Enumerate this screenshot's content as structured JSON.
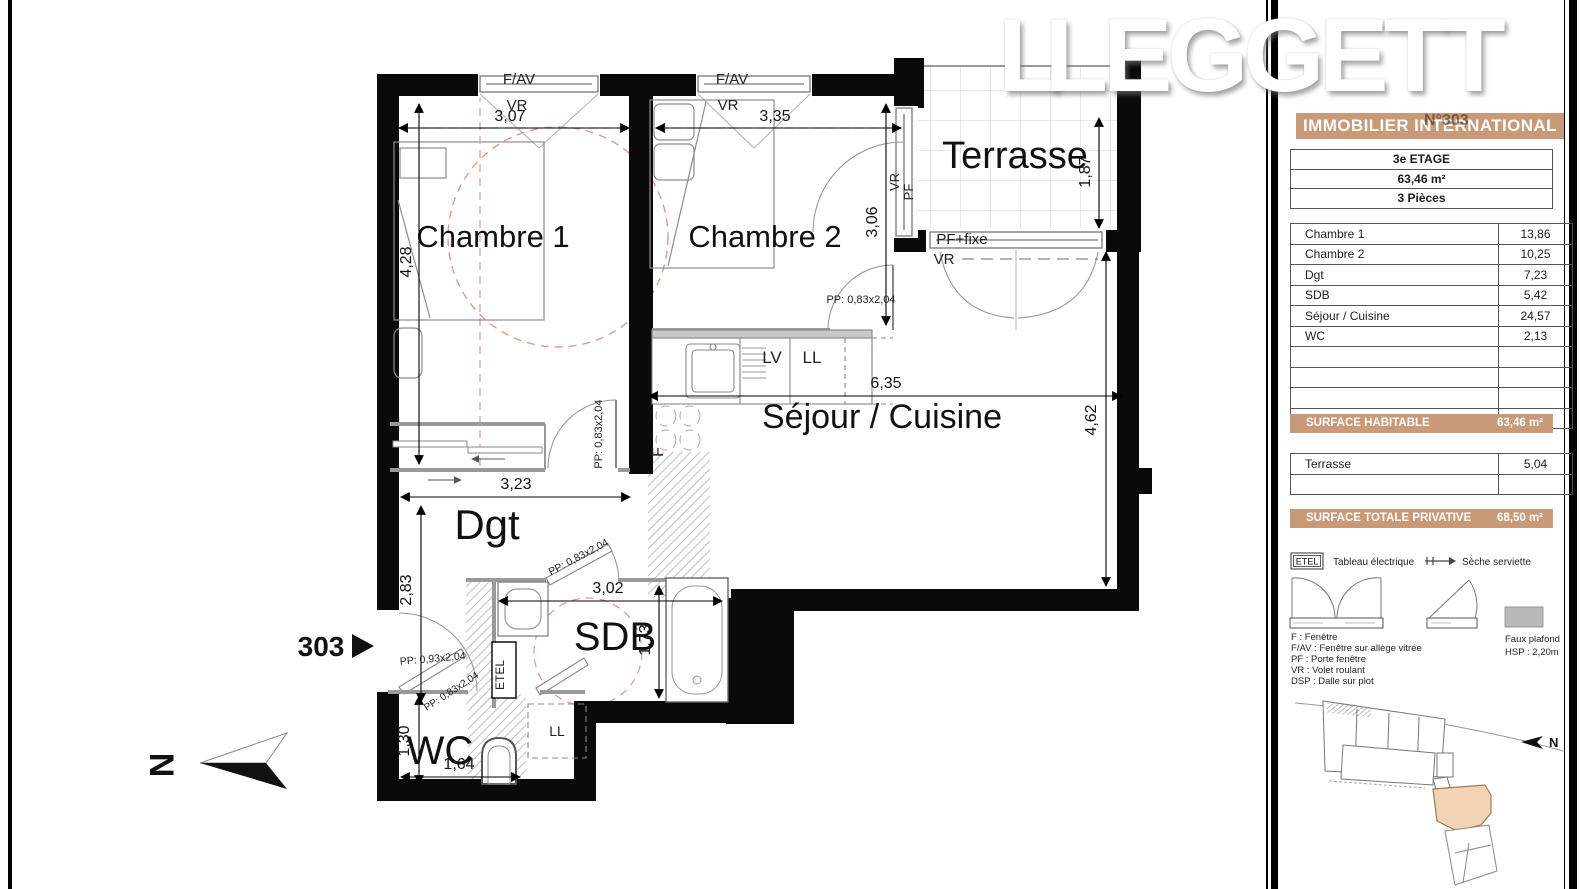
{
  "branding": {
    "mark": "L",
    "name": "LEGGETT",
    "tagline": "IMMOBILIER INTERNATIONAL",
    "unit_watermark": "N°303"
  },
  "colors": {
    "accent": "#c89a77",
    "highlight": "#f2d4b4",
    "red_dash": "#df9a92"
  },
  "panel": {
    "summary": {
      "floor": "3e ETAGE",
      "area": "63,46 m²",
      "rooms": "3 Pièces"
    },
    "rooms_table": {
      "rows": [
        {
          "label": "Chambre 1",
          "value": "13,86"
        },
        {
          "label": "Chambre 2",
          "value": "10,25"
        },
        {
          "label": "Dgt",
          "value": "7,23"
        },
        {
          "label": "SDB",
          "value": "5,42"
        },
        {
          "label": "Séjour / Cuisine",
          "value": "24,57"
        },
        {
          "label": "WC",
          "value": "2,13"
        }
      ]
    },
    "surface_habitable": {
      "label": "SURFACE HABITABLE",
      "value": "63,46 m²"
    },
    "terrasse_table": {
      "rows": [
        {
          "label": "Terrasse",
          "value": "5,04"
        }
      ]
    },
    "surface_totale": {
      "label": "SURFACE TOTALE PRIVATIVE",
      "value": "68,50 m²"
    },
    "legend": {
      "etel": "ETEL",
      "etel_label": "Tableau électrique",
      "seche_label": "Sèche serviette",
      "abbr": [
        "F : Fenêtre",
        "F/AV : Fenêtre sur allège vitrée",
        "PF : Porte fenêtre",
        "VR : Volet roulant",
        "DSP : Dalle sur plot"
      ],
      "faux_plafond": "Faux plafond",
      "hsp": "HSP : 2,20m"
    }
  },
  "plan": {
    "rooms": {
      "chambre1": "Chambre 1",
      "chambre2": "Chambre 2",
      "terrasse": "Terrasse",
      "sejour": "Séjour / Cuisine",
      "dgt": "Dgt",
      "sdb": "SDB",
      "wc": "WC"
    },
    "dims": {
      "w_ch1": "3,07",
      "w_ch2": "3,35",
      "h_ch1": "4,28",
      "h_ch2": "3,06",
      "h_terrasse": "1,87",
      "w_sejour": "6,35",
      "h_sejour": "4,62",
      "w_dgt": "3,23",
      "h_dgt": "2,83",
      "w_sdb": "3,02",
      "h_sdb": "1,73",
      "h_wc": "1,30",
      "w_wc": "1,64"
    },
    "labels": {
      "fav": "F/AV",
      "vr": "VR",
      "pf": "PF",
      "pf_fixe": "PF+fixe",
      "lv": "LV",
      "ll": "LL",
      "f": "F",
      "etel": "ETEL",
      "pp_083": "PP: 0,83x2,04",
      "pp_093": "PP: 0,93x2,04",
      "unit": "303",
      "north": "N"
    }
  }
}
